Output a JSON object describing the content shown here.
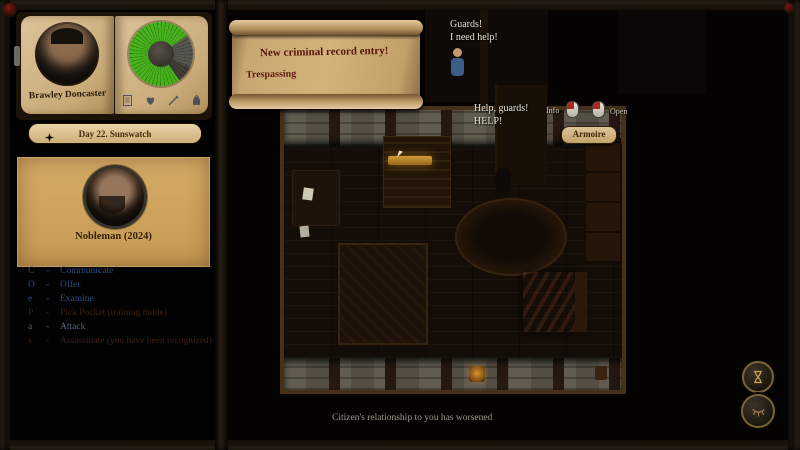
{
  "book": {
    "character_name": "Brawley Doncaster",
    "clock": {
      "fill_color": "#46b31c",
      "track_color": "#57554f"
    },
    "toolbar_icons": [
      "journal",
      "heart",
      "quill",
      "pouch"
    ]
  },
  "date_banner": {
    "text": "Day 22. Sunswatch"
  },
  "target_card": {
    "name": "Nobleman (2024)"
  },
  "action_menu": {
    "separator": "-",
    "items": [
      {
        "hotkey": "C",
        "label": "Communicate",
        "state": "enabled"
      },
      {
        "hotkey": "O",
        "label": "Offer",
        "state": "enabled"
      },
      {
        "hotkey": "e",
        "label": "Examine",
        "state": "enabled"
      },
      {
        "hotkey": "P",
        "label": "Pick Pocket (training mode)",
        "state": "disabled"
      },
      {
        "hotkey": "a",
        "label": "Attack",
        "state": "enabled"
      },
      {
        "hotkey": "s",
        "label": "Assassinate (you have been recognized)",
        "state": "disabled"
      }
    ]
  },
  "notification_scroll": {
    "title": "New criminal record entry!",
    "detail": "Trespassing"
  },
  "speech": {
    "npc_top_line1": "Guards!",
    "npc_top_line2": "I need help!",
    "victim_line1": "Help, guards!",
    "victim_line2": "HELP!"
  },
  "hover_tooltip": {
    "info_label": "Info",
    "open_label": "Open"
  },
  "object_label": "Armoire",
  "status_bar": {
    "message": "Citizen's relationship to you has worsened"
  },
  "colors": {
    "clock_green": "#46b31c",
    "mouse_button_red": "#a82820",
    "parchment": "#d4b27c",
    "bed_red": "#7c140c"
  }
}
